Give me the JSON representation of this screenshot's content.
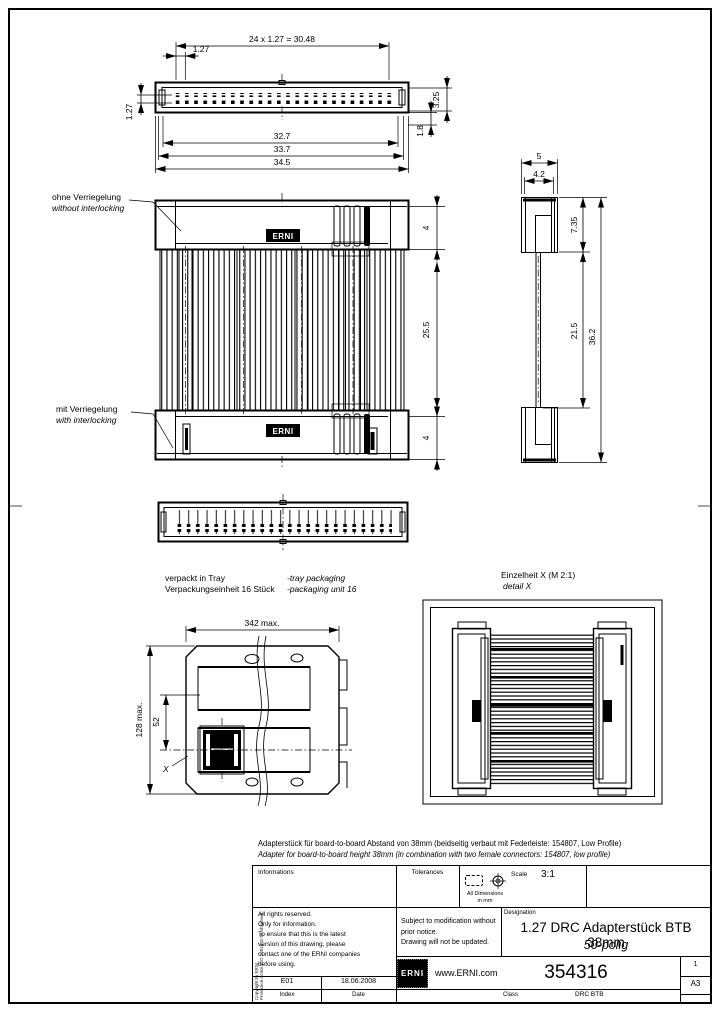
{
  "views": {
    "top": {
      "dim_pitch_total": "24 x 1.27 = 30.48",
      "dim_pitch": "1.27",
      "dim_row_pitch": "1.27",
      "dim_height": "3.25",
      "dim_pin": "1.8",
      "dim_width_inner": "32.7",
      "dim_width_mid": "33.7",
      "dim_width_outer": "34.5"
    },
    "front": {
      "label_no_lock_de": "ohne Verriegelung",
      "label_no_lock_en": "without interlocking",
      "label_lock_de": "mit Verriegelung",
      "label_lock_en": "with interlocking",
      "badge_top": "ERNI",
      "badge_bottom": "ERNI",
      "dim_cap_top": "4",
      "dim_body": "25.5",
      "dim_cap_bottom": "4"
    },
    "side": {
      "dim_width": "5",
      "dim_width_inner": "4.2",
      "dim_cap": "7.35",
      "dim_body": "21.5",
      "dim_total": "36.2"
    },
    "tray": {
      "note_de_1": "verpackt in Tray",
      "note_de_2": "Verpackungseinheit 16 Stück",
      "note_en_1": "-tray packaging",
      "note_en_2": "-packaging unit 16",
      "dim_width": "342 max.",
      "dim_height": "128 max.",
      "dim_pocket": "52",
      "detail_ref": "X"
    },
    "detail": {
      "title_de": "Einzelheit X  (M 2:1)",
      "title_en": "detail X"
    }
  },
  "description": {
    "de": "Adapterstück für board-to-board Abstand von 38mm (beidseitig verbaut mit Federleiste: 154807, Low Profile)",
    "en": "Adapter for board-to-board height 38mm (in combination with two female connectors: 154807, low profile)"
  },
  "title_block": {
    "informations_label": "Informations",
    "tolerances_label": "Tolerances",
    "all_dimensions": "All Dimensions",
    "in_mm": "in mm",
    "scale_label": "Scale",
    "scale_value": "3:1",
    "rights_note": "All rights reserved.\nOnly for information.\nTo ensure that this is the latest\nversion of this drawing, please\ncontact one of the ERNI companies\nbefore using.",
    "change_note": "Subject to modification without\nprior notice.\nDrawing will not be updated.",
    "designation_label": "Designation",
    "designation_line1": "1.27 DRC Adapterstück BTB 38mm",
    "designation_line2": "50-polig",
    "revision": "E01",
    "date": "18.06.2008",
    "index_label": "Index",
    "date_label": "Date",
    "logo_text": "ERNI",
    "website": "www.ERNI.com",
    "part_number": "354316",
    "class_label": "Class",
    "class_value": "DRC BTB",
    "sheet": "1",
    "format": "A3",
    "copyright_line1": "Copyright by ERNI",
    "copyright_line2": "Protection notice ISO 16016 to be observed"
  }
}
